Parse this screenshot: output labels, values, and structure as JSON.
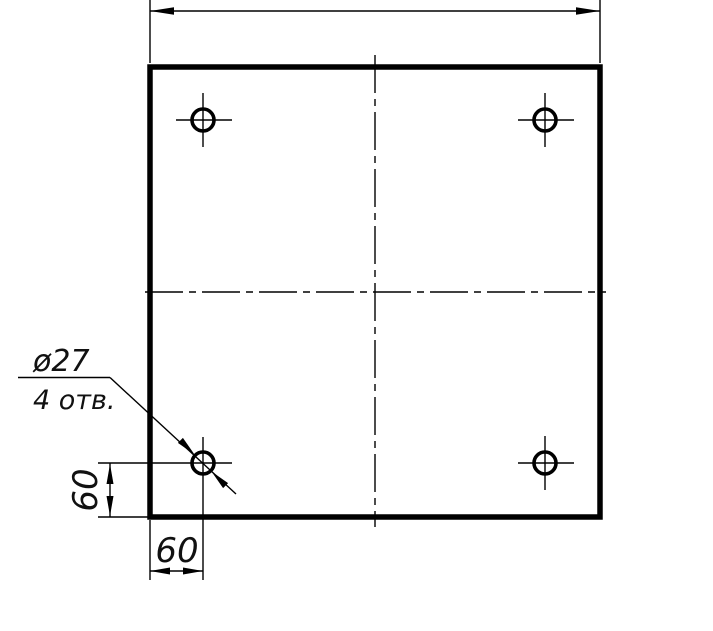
{
  "colors": {
    "ink": "#000000",
    "paper": "#ffffff"
  },
  "callout": {
    "line1": "ø27",
    "line2": "4 отв."
  },
  "dimensions": {
    "vertical_offset": "60",
    "horizontal_offset": "60"
  }
}
